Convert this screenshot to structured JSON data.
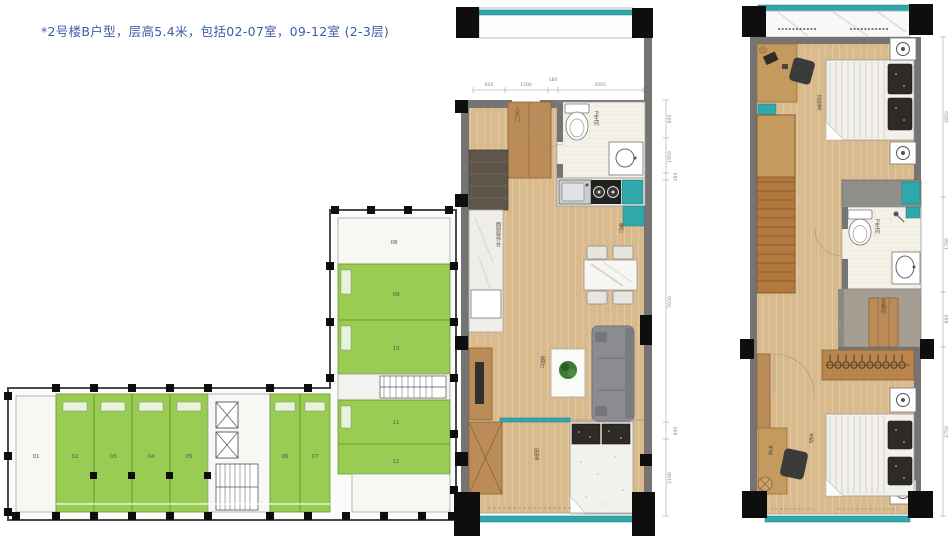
{
  "title": {
    "text": "*2号楼B户型，层高5.4米，包括02-07室，09-12室 (2-3层)",
    "color": "#3c5da8"
  },
  "colors": {
    "title_blue": "#3c5da8",
    "unit_green": "#8dc63f",
    "wall_gray": "#757472",
    "wood": "#d9ba8c",
    "teal": "#2fa7ab",
    "sofa_gray": "#8b8b92"
  },
  "key_plan": {
    "row_units": [
      {
        "label": "01",
        "highlighted": false
      },
      {
        "label": "02",
        "highlighted": true
      },
      {
        "label": "03",
        "highlighted": true
      },
      {
        "label": "04",
        "highlighted": true
      },
      {
        "label": "05",
        "highlighted": true
      },
      {
        "label": "06",
        "highlighted": true
      },
      {
        "label": "07",
        "highlighted": true
      }
    ],
    "wing_units": [
      {
        "label": "08",
        "highlighted": false
      },
      {
        "label": "09",
        "highlighted": true
      },
      {
        "label": "10",
        "highlighted": true
      },
      {
        "label": "11",
        "highlighted": true
      },
      {
        "label": "12",
        "highlighted": true
      }
    ]
  },
  "lower_plan": {
    "rooms": {
      "bathroom": "卫生间",
      "entry_door": "入户门",
      "west_kitchen_counter": "西厨操作台",
      "dining": "餐厅",
      "living": "客厅",
      "bedroom": "卧室"
    },
    "dims_top": [
      "600",
      "1500",
      "180",
      "3000"
    ],
    "dims_right": [
      "600",
      "1950",
      "180",
      "5030",
      "600",
      "2190"
    ]
  },
  "upper_plan": {
    "rooms": {
      "second_bedroom": "次卧室",
      "bathroom": "卫生间",
      "closet": "衣帽间",
      "master_bedroom": "主卧",
      "desk": "书桌"
    },
    "dims_right": [
      "2850",
      "1780",
      "890",
      "2750"
    ]
  }
}
